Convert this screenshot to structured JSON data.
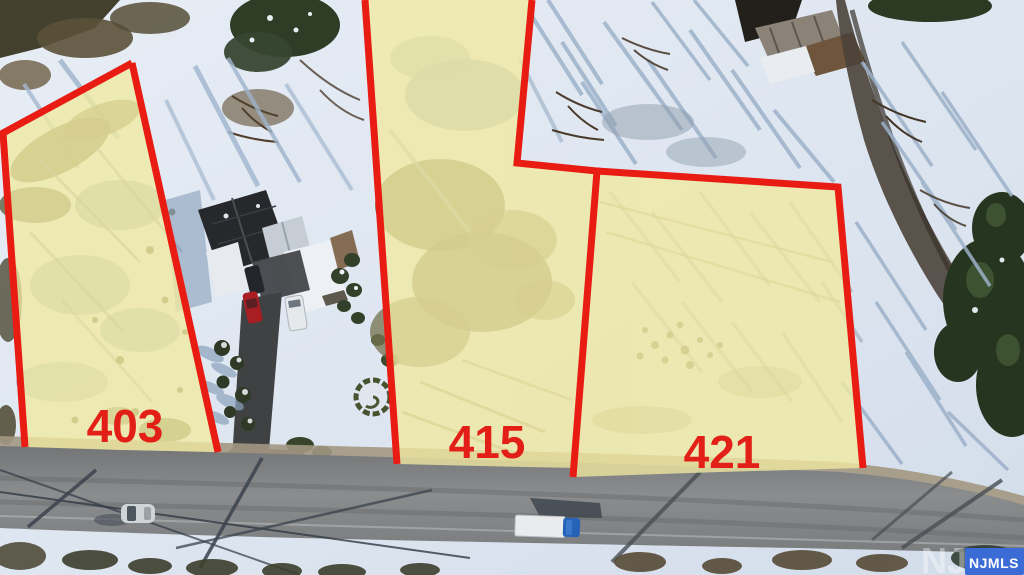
{
  "lots": [
    {
      "id": "403",
      "label": "403"
    },
    {
      "id": "415",
      "label": "415"
    },
    {
      "id": "421",
      "label": "421"
    }
  ],
  "watermark": {
    "badge_text": "NJMLS",
    "ghost_text": "NJMLS"
  },
  "colors": {
    "boundary_red": "#e81c12",
    "label_red": "#e22017",
    "lot_fill": "#f1e9a0",
    "badge_blue": "#3b6cd6",
    "badge_text_white": "#ffffff"
  }
}
